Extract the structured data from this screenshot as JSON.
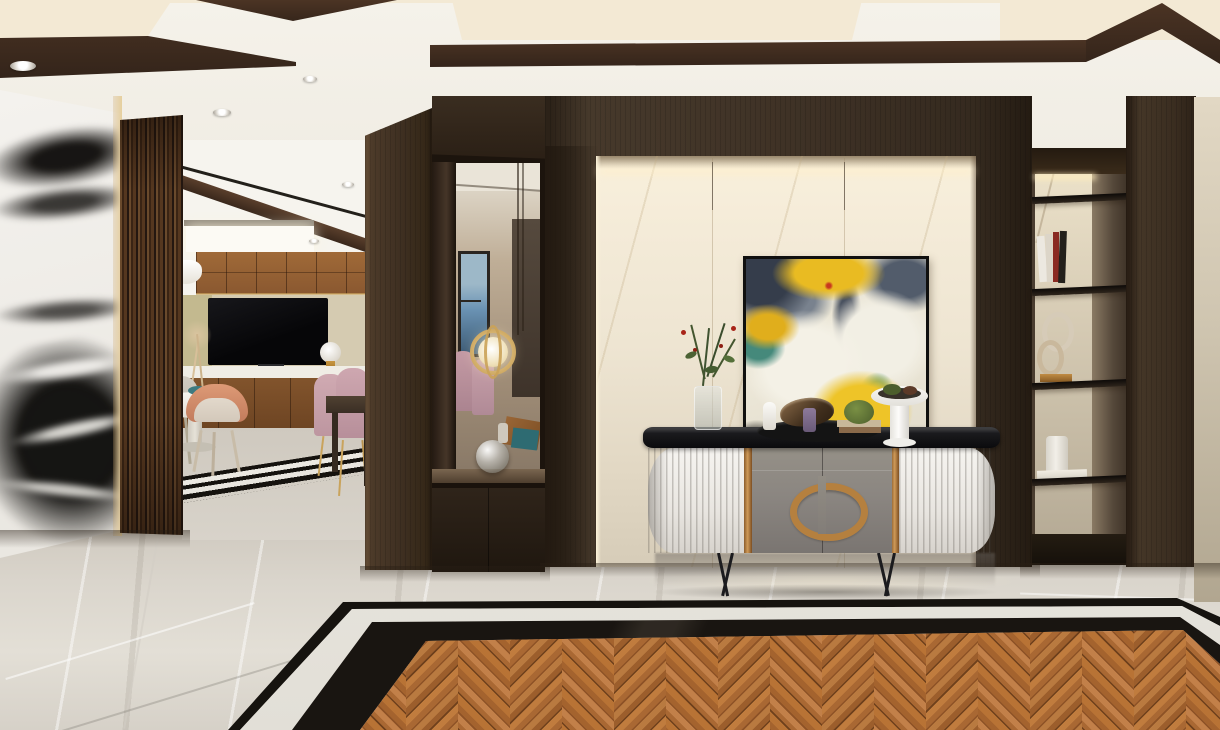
{
  "meta": {
    "title": "Modern entry hall interior rendering",
    "type": "3d-interior-render",
    "width_px": 1220,
    "height_px": 730
  },
  "palette": {
    "ceiling-cream": "#f3f0e8",
    "coffer-panel": "#f3e9d4",
    "coffer-brown": "#4c3424",
    "coffer-brown-dark": "#33241a",
    "wood": "#3f3226",
    "wood-dark": "#2c2117",
    "wood-mid": "#4e3d2c",
    "wood-light": "#6a5239",
    "slat-light": "#6a4a2c",
    "slat-dark": "#241710",
    "marble-white": "#f2f0ec",
    "vein-black": "#171513",
    "niche-top": "#f9f0dc",
    "niche-bottom": "#d6ccb8",
    "backwall": "#d5cbb1",
    "backwall-olive": "#c3b98f",
    "cab-wood": "#96653a",
    "cab-wood-dark": "#7c4f28",
    "tv-black": "#0a0a0c",
    "counter": "#f0ede5",
    "floor": "#d9d4cb",
    "floor-light": "#e3dfd6",
    "border-white": "#efece5",
    "border-black": "#16130f",
    "console-white": "#f4f2ee",
    "console-gray": "#8c8782",
    "console-gray-dark": "#7a7571",
    "console-top": "#121214",
    "bronze": "#b5803f",
    "gold": "#c9a35c",
    "mirror-beige": "#b3a28d",
    "window-blue": "#6b93b4",
    "chair-pink": "#c9a3ac",
    "chair-salmon": "#cf8d70",
    "chair-beige": "#d9cfc4",
    "wall-right": "#cfc5b0",
    "p-navy": "#353d4b",
    "p-slate": "#525c6b",
    "p-gray": "#79828e",
    "p-yellow": "#e9bb22",
    "p-teal": "#45897b",
    "p-white": "#f4f1e6",
    "p-red": "#b8301f",
    "plank-a": "#a96833",
    "plank-b": "#8d5226",
    "plank-c": "#c28049",
    "plank-seam": "#6e401c"
  },
  "scene": {
    "ceiling": {
      "finish": "white plaster with recessed dark-walnut coffers",
      "downlight_count": 7
    },
    "left_wall": {
      "material": "black-and-white panda marble slab with lit edge trim"
    },
    "partition": {
      "material": "vertical walnut slat screen"
    },
    "living_room": {
      "media_wall": "walnut upper cabinets, beige TV niche, white counter, walnut base cabinets",
      "tv": "wall-mounted black television",
      "table_lamp": "white globe lamp with brass base",
      "pendant": "white disc pendant lamp",
      "vase": "white vase with dried pampas",
      "dining": {
        "table": "round white pedestal table",
        "chairs": [
          "salmon",
          "grey",
          "pink velvet",
          "pink velvet"
        ],
        "side_table": "dark walnut table"
      },
      "floor_inlay": "black and white striped stone border"
    },
    "mirror_niche": {
      "frame": "dark walnut display box",
      "reflections": [
        "window with sea view",
        "pink dining chairs",
        "gold ring pendant light"
      ],
      "ledge_decor": [
        "clear glass sphere",
        "wood tray",
        "teal book"
      ]
    },
    "feature_wall": {
      "material": "dark walnut panelling around backlit cream marble niche",
      "artwork": {
        "style": "abstract painting",
        "colors": [
          "navy",
          "slate grey",
          "cream white",
          "yellow",
          "teal",
          "red accents"
        ],
        "frame": "thin black"
      }
    },
    "console": {
      "top": "black stone slab",
      "sides": "white fluted curved panels",
      "doors": "warm grey lacquer with bronze split-oval handle and bronze trim strips",
      "legs": "thin black metal A-frames",
      "decor": [
        "glass vase with red-berry branches",
        "black oval tray",
        "white figurine",
        "bronze bowl sculpture",
        "violet perfume bottle",
        "stacked books",
        "green moss plant",
        "white pedestal bowl with greenery"
      ]
    },
    "shelving_niche": {
      "shelf_count": 4,
      "back": "cream marble, lit from above",
      "items": [
        "leaning books",
        "gold double-ring sculpture",
        "white cup",
        "magazine"
      ]
    },
    "right_wall": {
      "material": "dark walnut column beside beige plaster wall"
    },
    "floor": {
      "field": "polished grey marble",
      "inlay_border": [
        "thin black line",
        "white stone band",
        "black marquina band"
      ],
      "center": "walnut herringbone parquet"
    }
  }
}
